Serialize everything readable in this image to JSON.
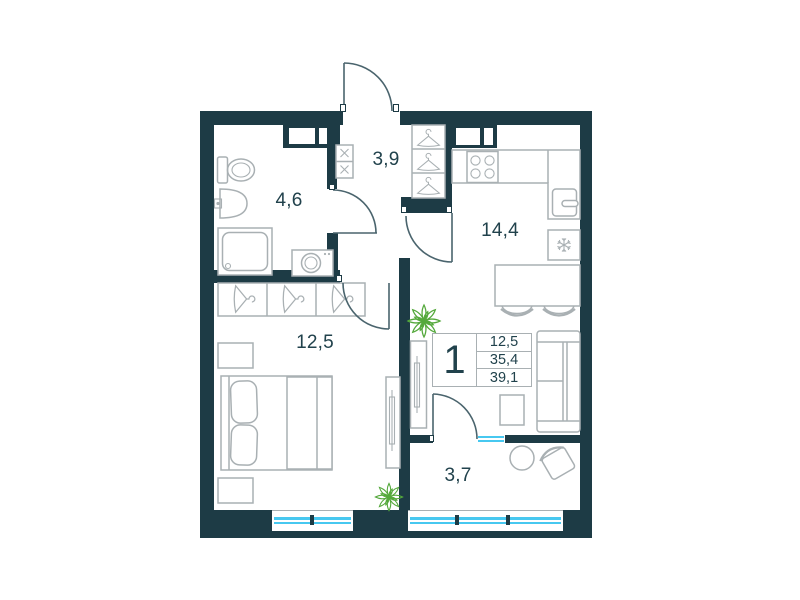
{
  "colors": {
    "wall": "#1d3b45",
    "line": "#a9b0b3",
    "door": "#4a646d",
    "glass": "#47c8f0",
    "plant": "#55a93c",
    "text": "#21424c",
    "bg": "#ffffff"
  },
  "plan": {
    "type": "apartment-floor-plan",
    "rooms": {
      "bathroom": {
        "label": "4,6"
      },
      "hallway": {
        "label": "3,9"
      },
      "kitchen_living": {
        "label": "14,4"
      },
      "bedroom": {
        "label": "12,5"
      },
      "balcony": {
        "label": "3,7"
      }
    },
    "info_box": {
      "rooms_count": "1",
      "values": [
        "12,5",
        "35,4",
        "39,1"
      ]
    },
    "fixture_icons": [
      "toilet",
      "washbasin",
      "shower",
      "washing-machine",
      "meter-box-icon",
      "hanger-icon",
      "stove-burners-icon",
      "kitchen-sink",
      "fridge-snowflake-icon",
      "dining-table",
      "chair",
      "sofa",
      "side-table",
      "tv-console",
      "bed",
      "nightstand",
      "wardrobe",
      "balcony-table",
      "armchair",
      "plant-icon",
      "window-glazing",
      "door-swing"
    ]
  }
}
